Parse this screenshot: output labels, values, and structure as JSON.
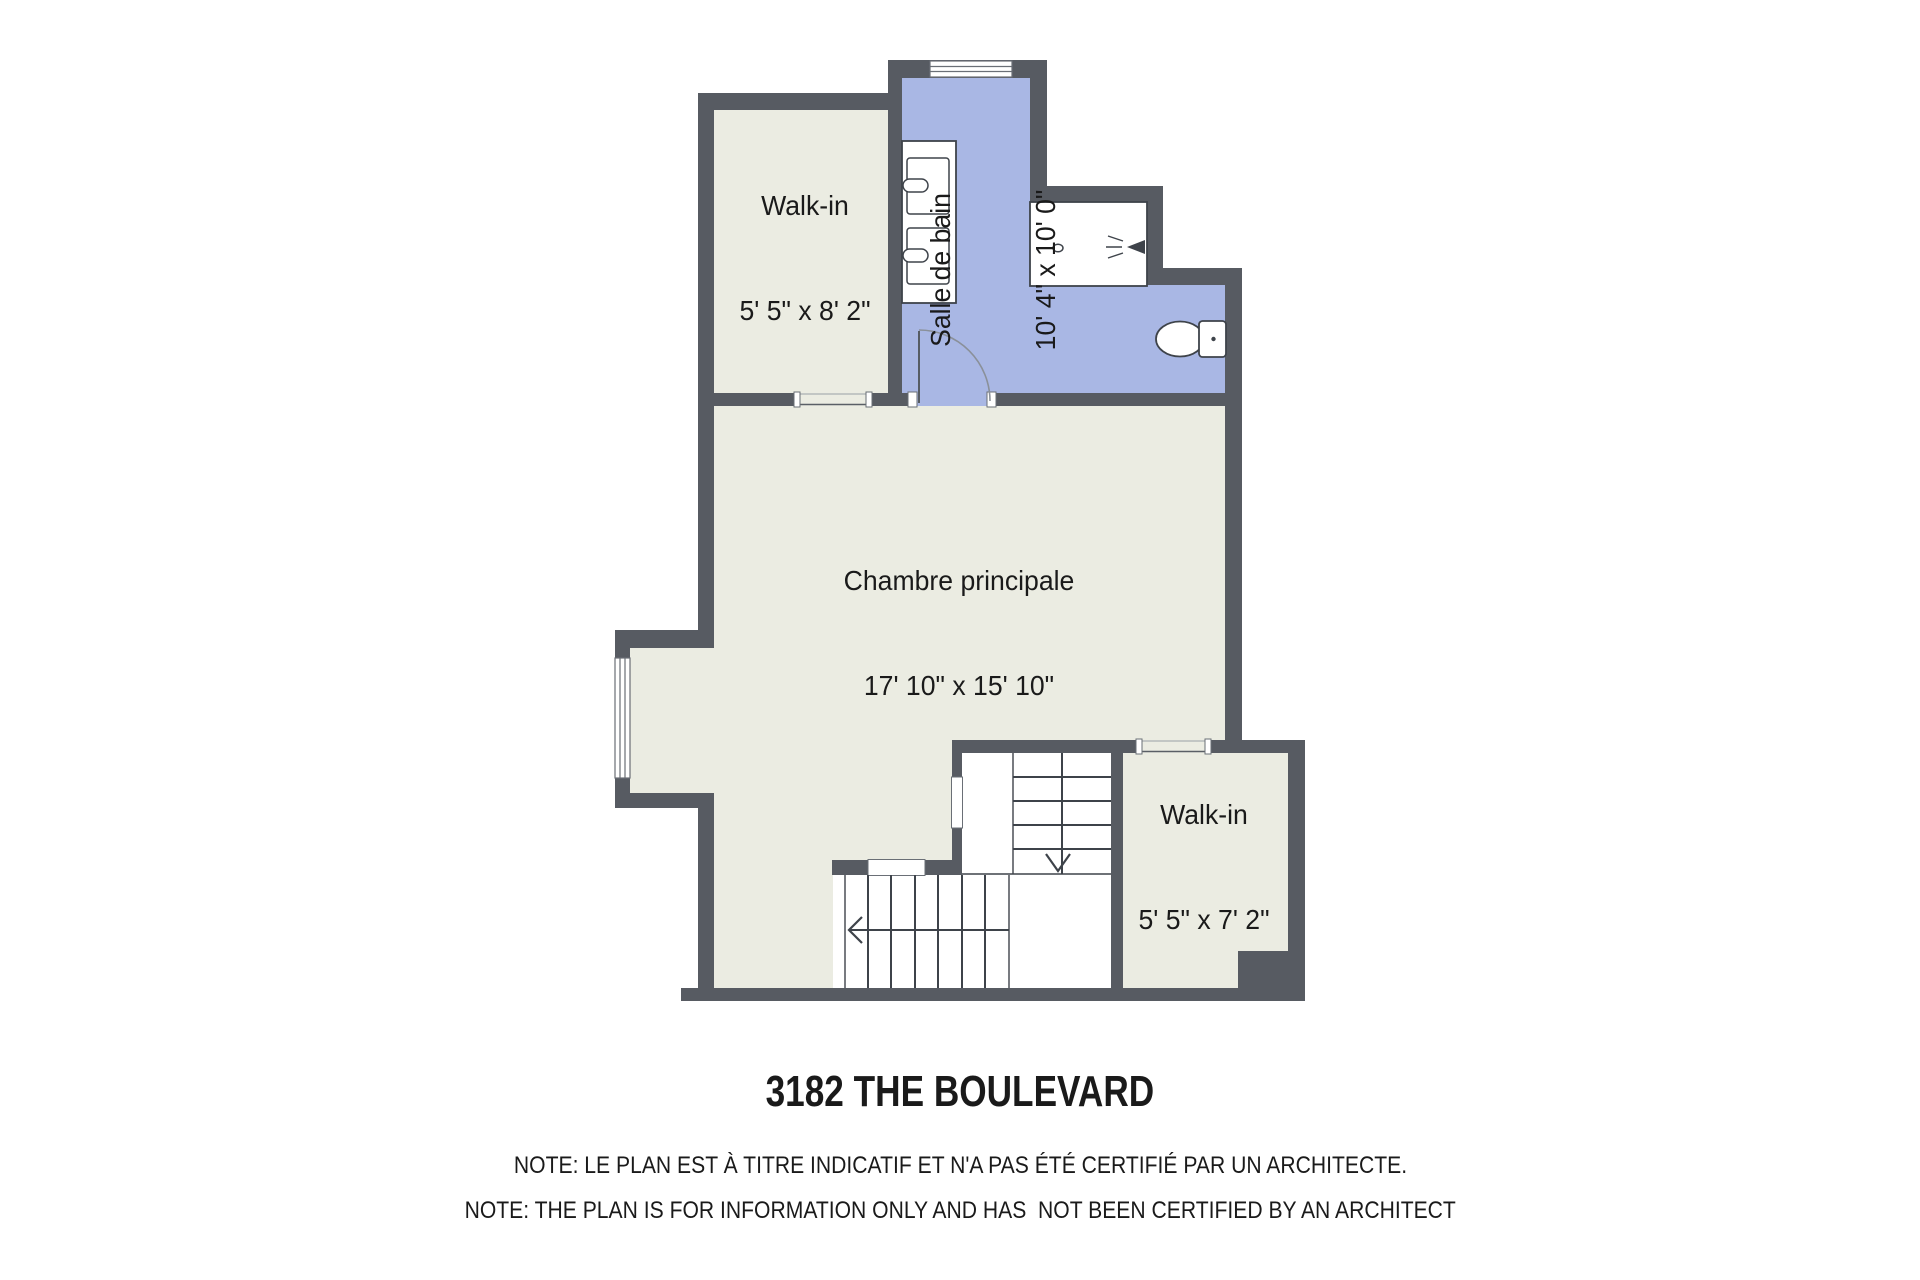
{
  "colors": {
    "wall": "#575b62",
    "floor": "#ebece2",
    "bath": "#a9b7e4",
    "line": "#3e434a",
    "text": "#1a1a1a"
  },
  "rooms": {
    "walkin_top": {
      "name": "Walk-in",
      "dims": "5' 5\" x 8' 2\""
    },
    "bathroom": {
      "name": "Salle de bain",
      "dims": "10' 4\" x 10' 0\""
    },
    "bedroom": {
      "name": "Chambre principale",
      "dims": "17' 10\" x 15' 10\""
    },
    "walkin_bottom": {
      "name": "Walk-in",
      "dims": "5' 5\" x 7' 2\""
    }
  },
  "footer": {
    "title": "3182 THE BOULEVARD",
    "note_fr": "NOTE: LE PLAN EST À TITRE INDICATIF ET N'A PAS ÉTÉ CERTIFIÉ PAR UN ARCHITECTE.",
    "note_en": "NOTE: THE PLAN IS FOR INFORMATION ONLY AND HAS  NOT BEEN CERTIFIED BY AN ARCHITECT"
  }
}
